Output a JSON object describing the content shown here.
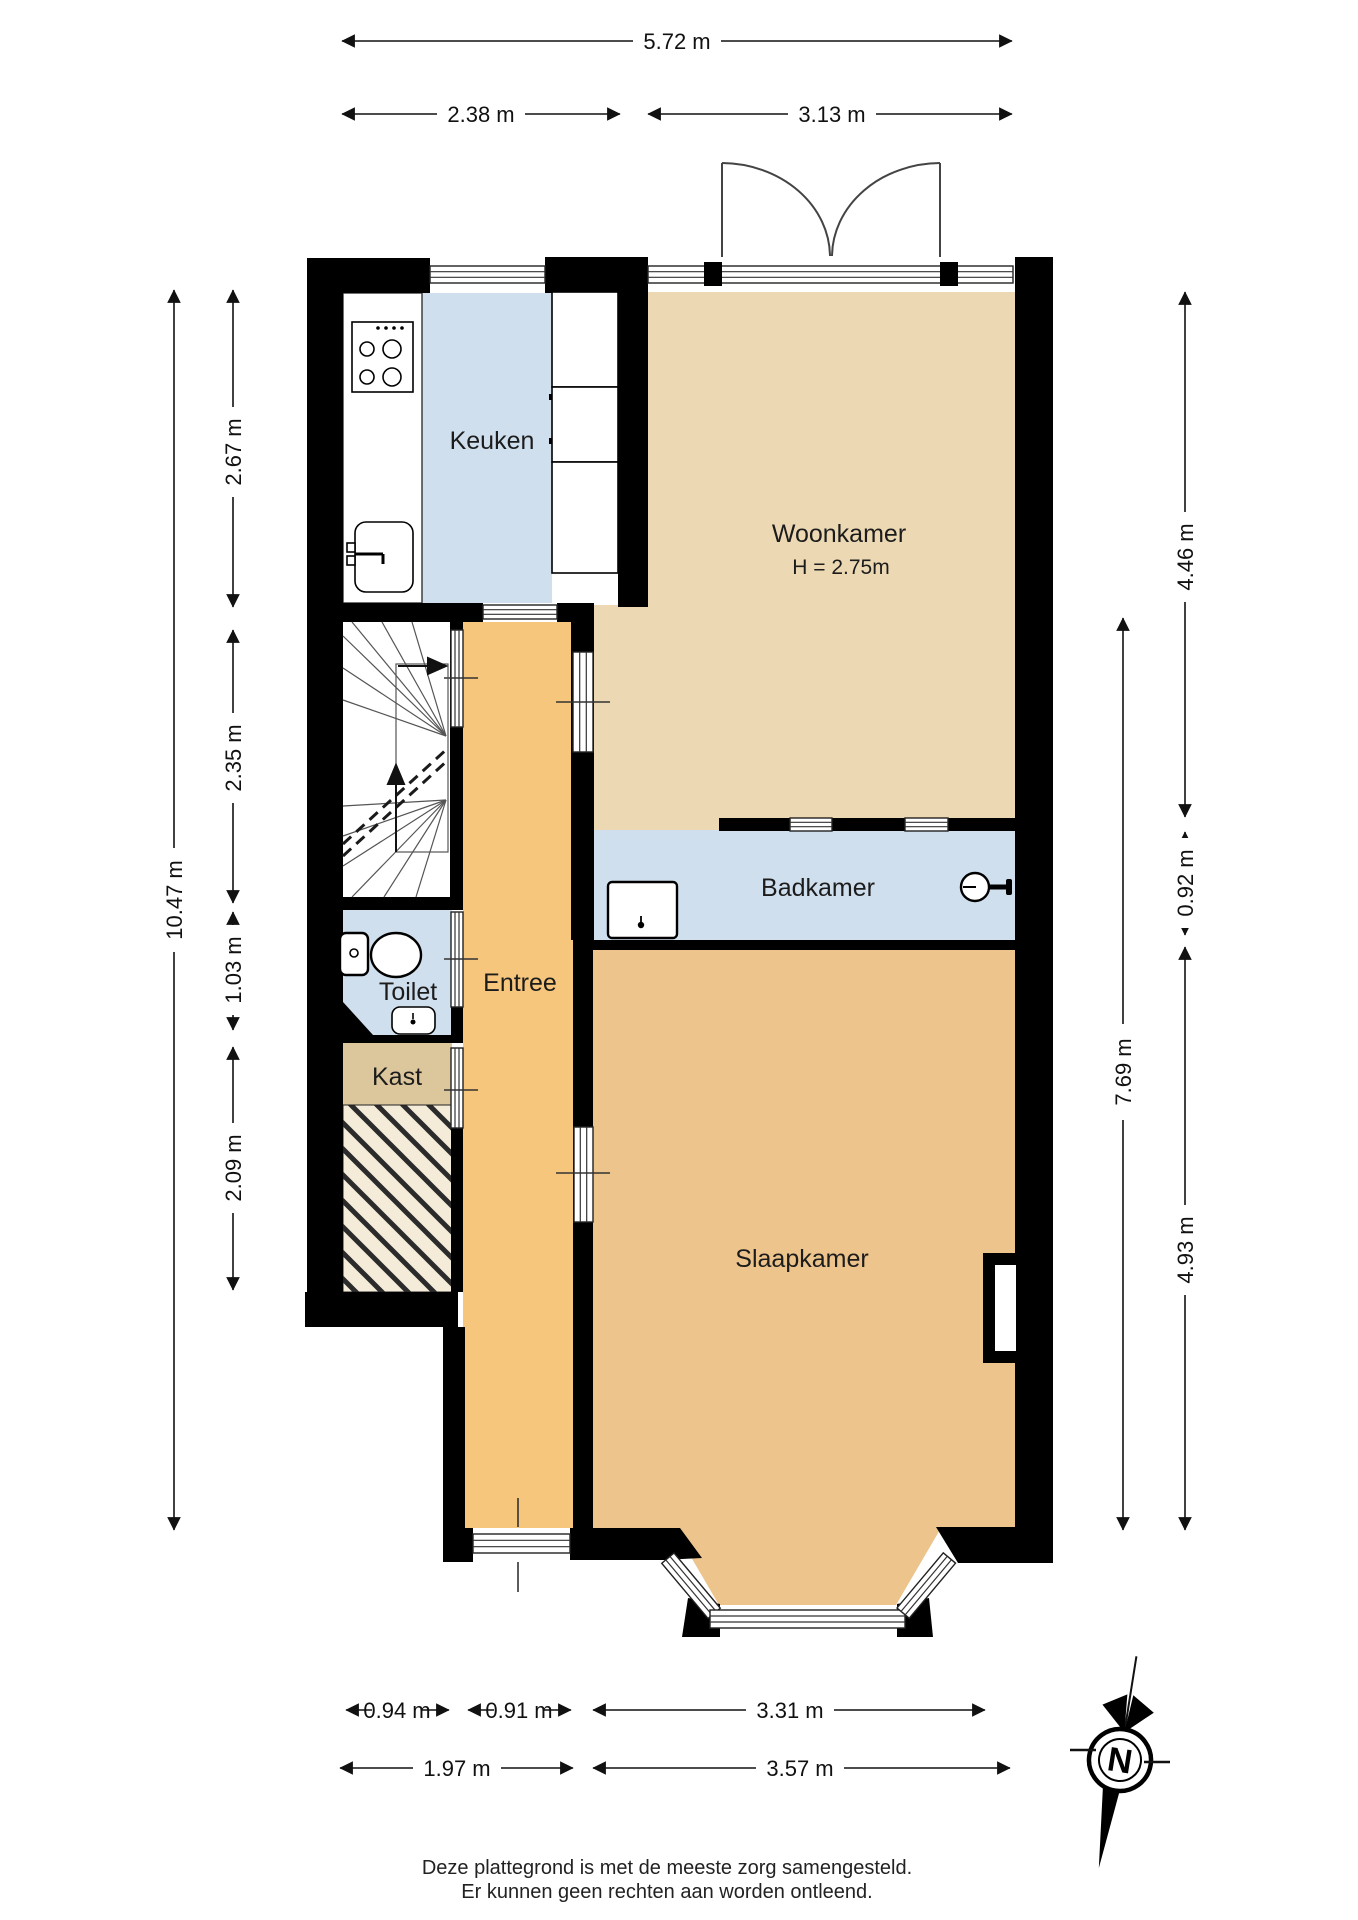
{
  "rooms": {
    "keuken": {
      "label": "Keuken"
    },
    "woonkamer": {
      "label": "Woonkamer",
      "ceiling_height": "H = 2.75m"
    },
    "badkamer": {
      "label": "Badkamer"
    },
    "toilet": {
      "label": "Toilet"
    },
    "kast": {
      "label": "Kast"
    },
    "entree": {
      "label": "Entree"
    },
    "slaapkamer": {
      "label": "Slaapkamer"
    }
  },
  "dimensions": {
    "top": {
      "total": "5.72 m",
      "left": "2.38 m",
      "right": "3.13 m"
    },
    "left": {
      "total": "10.47 m",
      "segments": [
        "2.67 m",
        "2.35 m",
        "1.03 m",
        "2.09 m"
      ]
    },
    "right": {
      "inner_total": "7.69 m",
      "segments": [
        "4.46 m",
        "0.92 m",
        "4.93 m"
      ]
    },
    "bottom": {
      "row1": [
        "0.94 m",
        "0.91 m",
        "3.31 m"
      ],
      "row2": [
        "1.97 m",
        "3.57 m"
      ]
    }
  },
  "compass": {
    "north_label": "N"
  },
  "footer": {
    "line1": "Deze plattegrond is met de meeste zorg samengesteld.",
    "line2": "Er kunnen geen rechten aan worden ontleend."
  },
  "colors": {
    "wall": "#000000",
    "wet_room_floor": "#cfdfed",
    "living_room_floor": "#ecd9b3",
    "hall_floor": "#f6c67d",
    "bedroom_floor": "#ecc48c",
    "closet_floor": "#dcc69c",
    "under_stairs_hatch_bg": "#f4ecd9",
    "line": "#1a1a1a"
  }
}
